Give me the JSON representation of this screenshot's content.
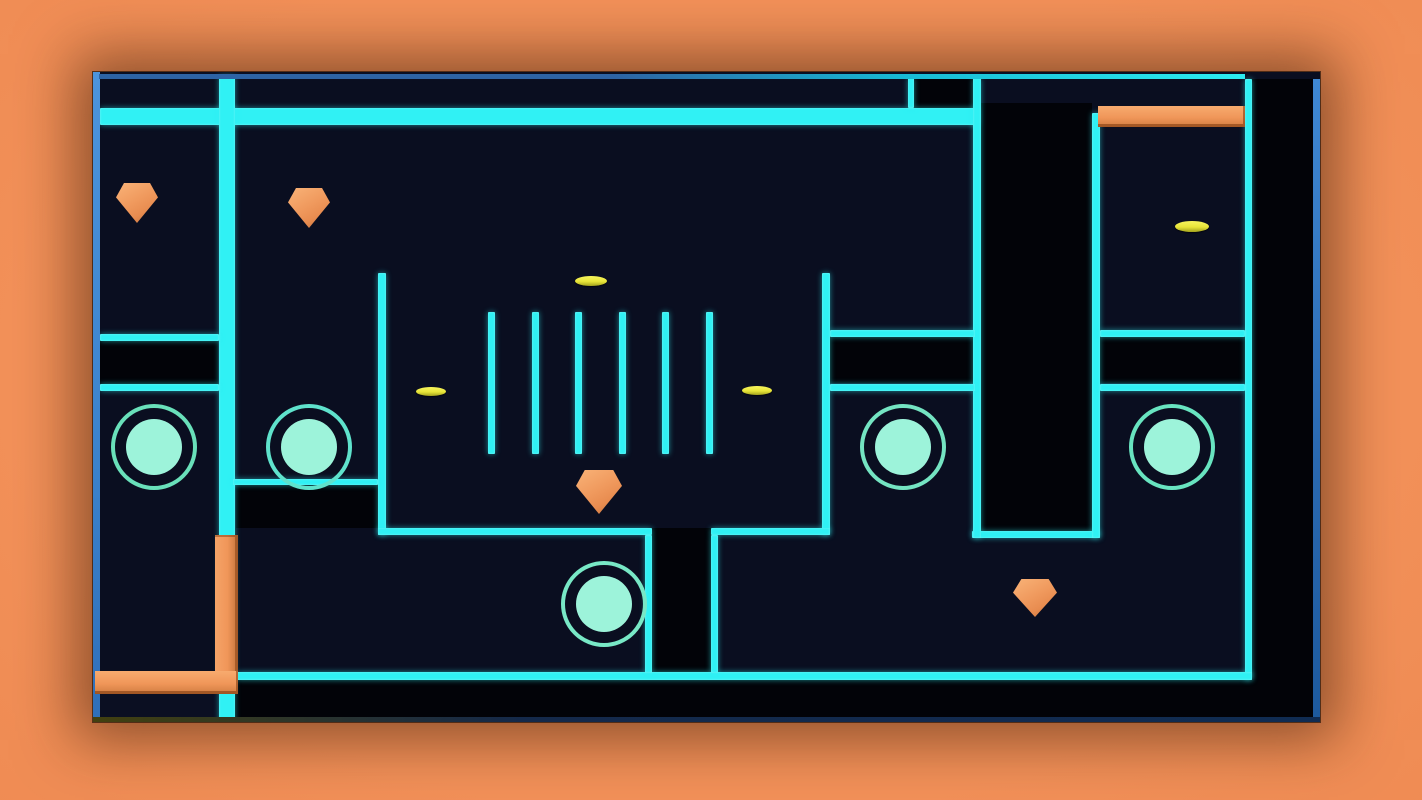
{
  "meta": {
    "description": "neon top-down maze game level with cyan walls, pits, orange pentagon hazards, coin discs and ring pads"
  },
  "colors": {
    "background_orange": "#ee8a52",
    "background_corner": "#a75e2e",
    "floor_navy": "#0a0e20",
    "pit_black": "#020308",
    "wall_cyan": "#30f1f4",
    "frame_blue": "#3e86d2",
    "bar_orange": "#f09659",
    "coin_yellow": "#e8e539",
    "pad_ring": "#74e4c2",
    "pad_fill": "#9df3da"
  },
  "frame": {
    "x": 93,
    "y": 72,
    "w": 1227,
    "h": 650
  },
  "scene_items": [
    {
      "n": "pit",
      "k": "pit",
      "r": [
        820,
        6,
        62,
        30
      ]
    },
    {
      "n": "pit-pillar-top",
      "k": "pit",
      "r": [
        887,
        31,
        112,
        429
      ]
    },
    {
      "n": "pit-right-band",
      "k": "pit",
      "r": [
        1159,
        7,
        63,
        639
      ]
    },
    {
      "n": "pit",
      "k": "pit",
      "r": [
        7,
        268,
        118,
        44
      ]
    },
    {
      "n": "pit",
      "k": "pit",
      "r": [
        143,
        412,
        142,
        44
      ]
    },
    {
      "n": "pit",
      "k": "pit",
      "r": [
        737,
        264,
        145,
        47
      ]
    },
    {
      "n": "pit",
      "k": "pit",
      "r": [
        1007,
        264,
        145,
        47
      ]
    },
    {
      "n": "pit-pillar-bottom",
      "k": "pit",
      "r": [
        559,
        456,
        59,
        145
      ]
    },
    {
      "n": "pit-bottom-band",
      "k": "pit",
      "r": [
        7,
        608,
        1213,
        38
      ]
    },
    {
      "n": "floor-patch",
      "k": "patch",
      "r": [
        7,
        622,
        119,
        24
      ]
    },
    {
      "n": "cyan-wall",
      "k": "wall",
      "r": [
        7,
        36,
        878,
        17
      ]
    },
    {
      "n": "cyan-wall",
      "k": "wall",
      "r": [
        126,
        4,
        16,
        646
      ]
    },
    {
      "n": "cyan-wall",
      "k": "wall",
      "r": [
        7,
        262,
        119,
        7
      ]
    },
    {
      "n": "cyan-wall",
      "k": "wall",
      "r": [
        7,
        312,
        119,
        7
      ]
    },
    {
      "n": "cyan-wall",
      "k": "wall",
      "r": [
        285,
        201,
        8,
        262
      ]
    },
    {
      "n": "cyan-wall",
      "k": "wall",
      "r": [
        729,
        201,
        8,
        262
      ]
    },
    {
      "n": "cyan-wall",
      "k": "wall",
      "r": [
        285,
        456,
        274,
        7
      ]
    },
    {
      "n": "cyan-wall",
      "k": "wall",
      "r": [
        618,
        456,
        119,
        7
      ]
    },
    {
      "n": "cyan-wall",
      "k": "wall",
      "r": [
        879,
        459,
        128,
        7
      ]
    },
    {
      "n": "cyan-wall",
      "k": "wall",
      "r": [
        140,
        407,
        145,
        6
      ]
    },
    {
      "n": "cyan-wall",
      "k": "wall",
      "r": [
        880,
        6,
        8,
        460
      ]
    },
    {
      "n": "cyan-wall",
      "k": "wall",
      "r": [
        999,
        41,
        8,
        425
      ]
    },
    {
      "n": "cyan-wall",
      "k": "wall",
      "r": [
        815,
        6,
        6,
        30
      ]
    },
    {
      "n": "cyan-wall",
      "k": "wall",
      "r": [
        737,
        258,
        145,
        7
      ]
    },
    {
      "n": "cyan-wall",
      "k": "wall",
      "r": [
        737,
        312,
        145,
        7
      ]
    },
    {
      "n": "cyan-wall",
      "k": "wall",
      "r": [
        1007,
        258,
        145,
        7
      ]
    },
    {
      "n": "cyan-wall",
      "k": "wall",
      "r": [
        1007,
        312,
        145,
        7
      ]
    },
    {
      "n": "cyan-wall",
      "k": "wall",
      "r": [
        1152,
        7,
        7,
        601
      ]
    },
    {
      "n": "cyan-wall",
      "k": "wall",
      "r": [
        144,
        600,
        1015,
        8
      ]
    },
    {
      "n": "cyan-wall",
      "k": "wall",
      "r": [
        552,
        463,
        7,
        138
      ]
    },
    {
      "n": "cyan-wall",
      "k": "wall",
      "r": [
        618,
        463,
        7,
        138
      ]
    },
    {
      "n": "comb-bar",
      "k": "wall",
      "r": [
        395,
        240,
        7,
        142
      ]
    },
    {
      "n": "comb-bar",
      "k": "wall",
      "r": [
        439,
        240,
        7,
        142
      ]
    },
    {
      "n": "comb-bar",
      "k": "wall",
      "r": [
        482,
        240,
        7,
        142
      ]
    },
    {
      "n": "comb-bar",
      "k": "wall",
      "r": [
        526,
        240,
        7,
        142
      ]
    },
    {
      "n": "comb-bar",
      "k": "wall",
      "r": [
        569,
        240,
        7,
        142
      ]
    },
    {
      "n": "comb-bar",
      "k": "wall",
      "r": [
        613,
        240,
        7,
        142
      ]
    },
    {
      "n": "frame-edge-left",
      "k": "edge-left",
      "r": [
        0,
        0,
        7,
        650
      ]
    },
    {
      "n": "frame-edge-right",
      "k": "edge-right",
      "r": [
        1220,
        7,
        7,
        639
      ]
    },
    {
      "n": "frame-edge-top",
      "k": "edge-top",
      "r": [
        6,
        2,
        1146,
        5
      ]
    },
    {
      "n": "frame-edge-bottom",
      "k": "edge-bottom",
      "r": [
        0,
        645,
        1227,
        5
      ]
    },
    {
      "n": "orange-bar-top-right",
      "k": "obar",
      "r": [
        1005,
        34,
        147,
        21
      ]
    },
    {
      "n": "orange-bar-vertical",
      "k": "obar",
      "r": [
        122,
        463,
        23,
        141
      ]
    },
    {
      "n": "orange-bar-bottom-left",
      "k": "obar",
      "r": [
        2,
        599,
        143,
        23
      ]
    },
    {
      "n": "portal-pad",
      "k": "pad",
      "r": [
        18,
        332,
        78,
        78
      ],
      "ring": "#69e0ba"
    },
    {
      "n": "portal-pad",
      "k": "pad",
      "r": [
        173,
        332,
        78,
        78
      ],
      "ring": "#5fe2cc"
    },
    {
      "n": "portal-pad",
      "k": "pad",
      "r": [
        468,
        489,
        78,
        78
      ],
      "ring": "#78e8c6"
    },
    {
      "n": "portal-pad",
      "k": "pad",
      "r": [
        767,
        332,
        78,
        78
      ],
      "ring": "#74e4c2"
    },
    {
      "n": "portal-pad",
      "k": "pad",
      "r": [
        1036,
        332,
        78,
        78
      ],
      "ring": "#68e4c0"
    },
    {
      "n": "coin-disc",
      "k": "coin",
      "r": [
        482,
        204,
        32,
        10
      ]
    },
    {
      "n": "coin-disc",
      "k": "coin",
      "r": [
        323,
        315,
        30,
        9
      ]
    },
    {
      "n": "coin-disc",
      "k": "coin",
      "r": [
        649,
        314,
        30,
        9
      ]
    },
    {
      "n": "coin-disc",
      "k": "coin",
      "r": [
        1082,
        149,
        34,
        11
      ]
    },
    {
      "n": "hazard-pentagon",
      "k": "pent",
      "r": [
        23,
        111,
        42,
        40
      ]
    },
    {
      "n": "hazard-pentagon",
      "k": "pent",
      "r": [
        195,
        116,
        42,
        40
      ]
    },
    {
      "n": "hazard-pentagon",
      "k": "pent",
      "r": [
        483,
        398,
        46,
        44
      ]
    },
    {
      "n": "hazard-pentagon",
      "k": "pent",
      "r": [
        920,
        507,
        44,
        38
      ]
    }
  ]
}
